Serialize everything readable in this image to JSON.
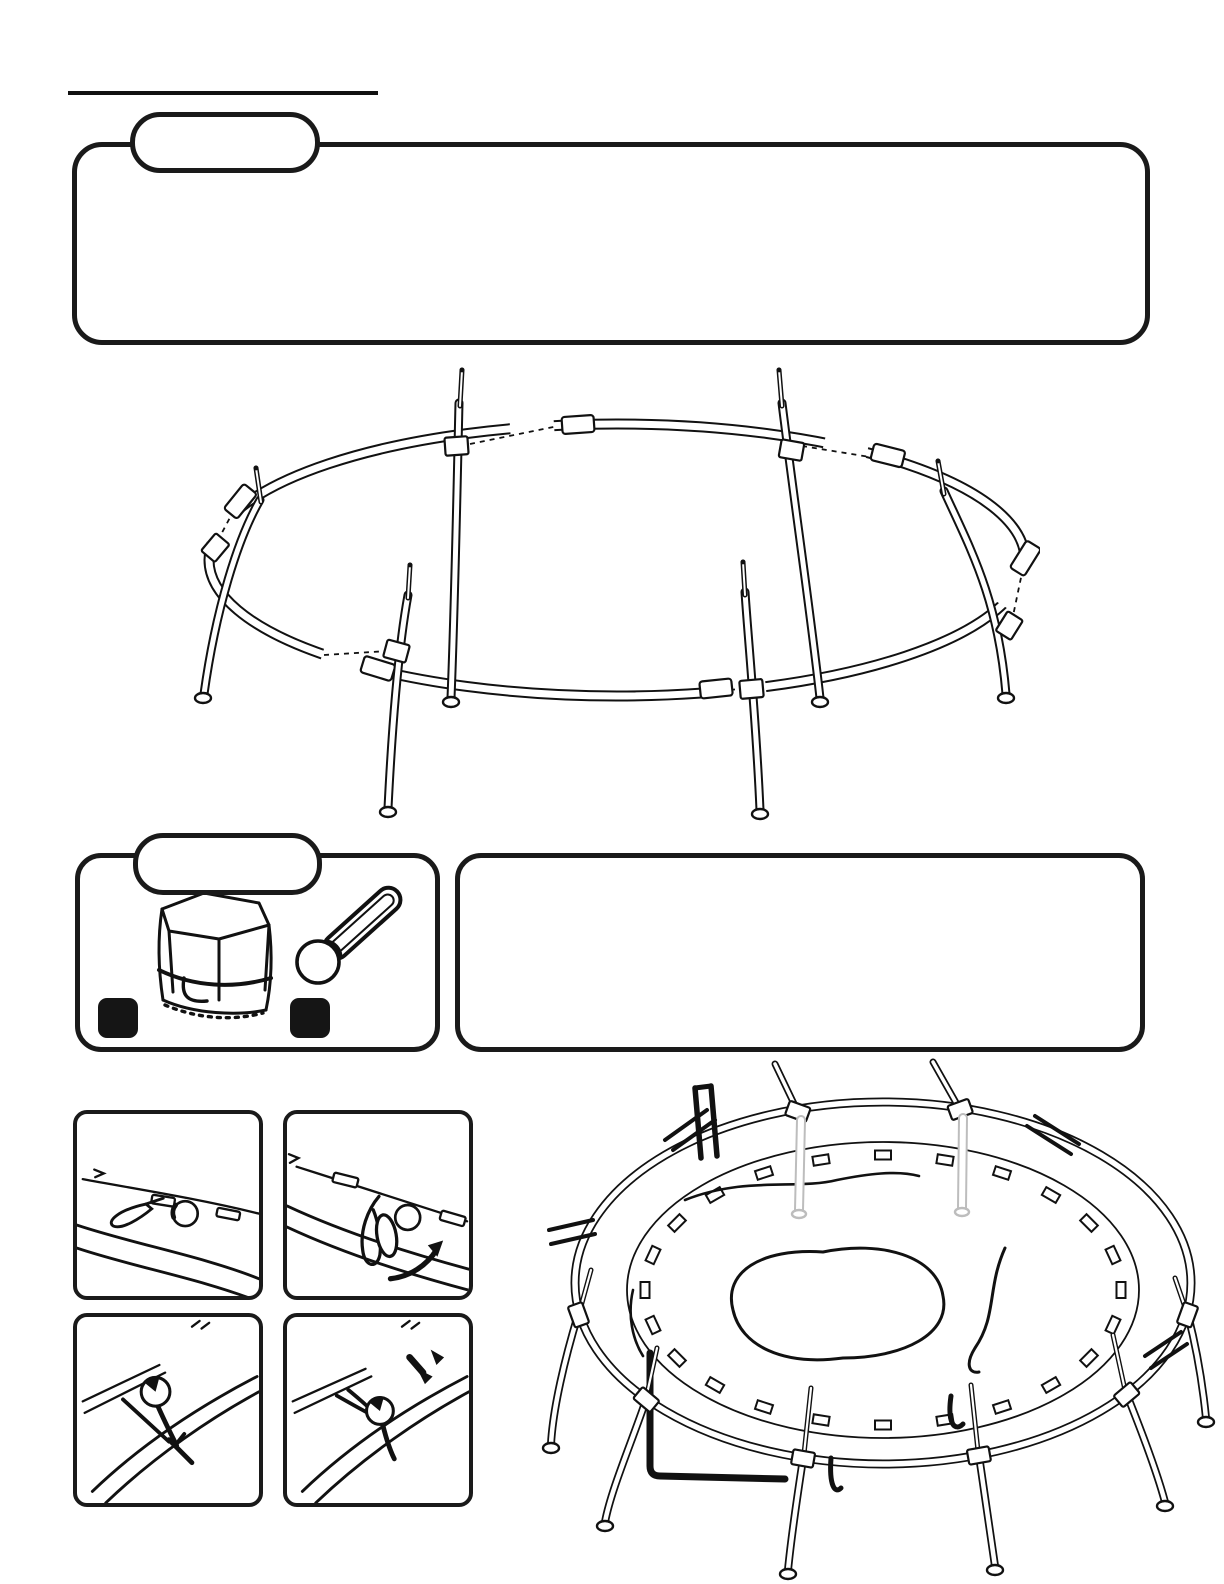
{
  "colors": {
    "ink": "#111111",
    "paper": "#ffffff",
    "ghost_gray": "#c3c3c3",
    "tag_black": "#151515"
  },
  "note_box": {
    "badge_label": "",
    "body": ""
  },
  "parts_box": {
    "badge_label": "",
    "items": [
      {
        "icon": "storage-bag-icon",
        "tag_label": ""
      },
      {
        "icon": "pull-tool-icon",
        "tag_label": ""
      }
    ]
  },
  "info_box": {
    "body": ""
  },
  "detail_panels": [
    {
      "icon": "mat-loop-and-grommet-icon"
    },
    {
      "icon": "loop-wrap-around-rail-arrow-icon"
    },
    {
      "icon": "pull-tool-hooked-on-loop-icon"
    },
    {
      "icon": "pull-tool-pull-down-icon"
    }
  ],
  "illustrations": [
    {
      "icon": "frame-ring-exploded-icon"
    },
    {
      "icon": "trampoline-mat-installed-icon"
    }
  ]
}
